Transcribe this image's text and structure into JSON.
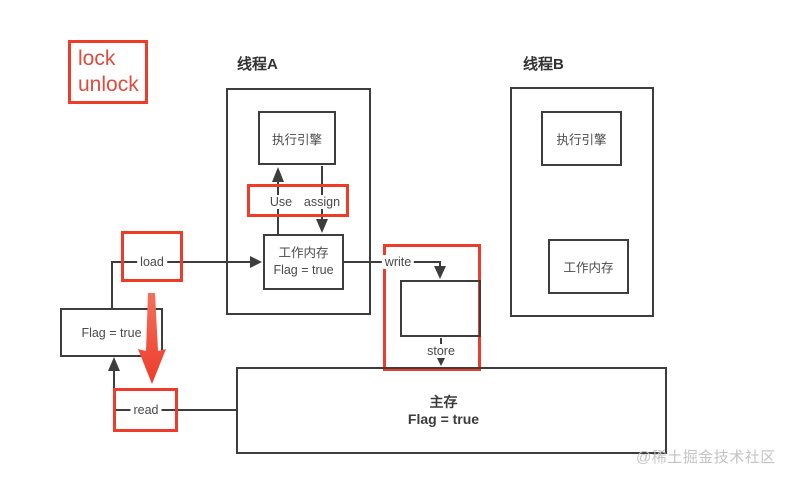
{
  "legend": {
    "line1": "lock",
    "line2": "unlock"
  },
  "thread_a": {
    "title": "线程A",
    "execution_engine_label": "执行引擎",
    "use_label": "Use",
    "assign_label": "assign",
    "working_memory_title": "工作内存",
    "working_memory_value": "Flag = true"
  },
  "thread_b": {
    "title": "线程B",
    "execution_engine_label": "执行引擎",
    "working_memory_label": "工作内存"
  },
  "memory_ops": {
    "load_label": "load",
    "read_label": "read",
    "write_label": "write",
    "store_label": "store"
  },
  "left_flag_box": {
    "value": "Flag = true"
  },
  "main_memory": {
    "title": "主存",
    "value": "Flag = true"
  },
  "watermark": "@稀土掘金技术社区",
  "colors": {
    "highlight_red": "#ee3b2a",
    "line_dark": "#3d3d3d",
    "label_text": "#4a4a4a",
    "watermark_gray": "#c3c3c3"
  }
}
